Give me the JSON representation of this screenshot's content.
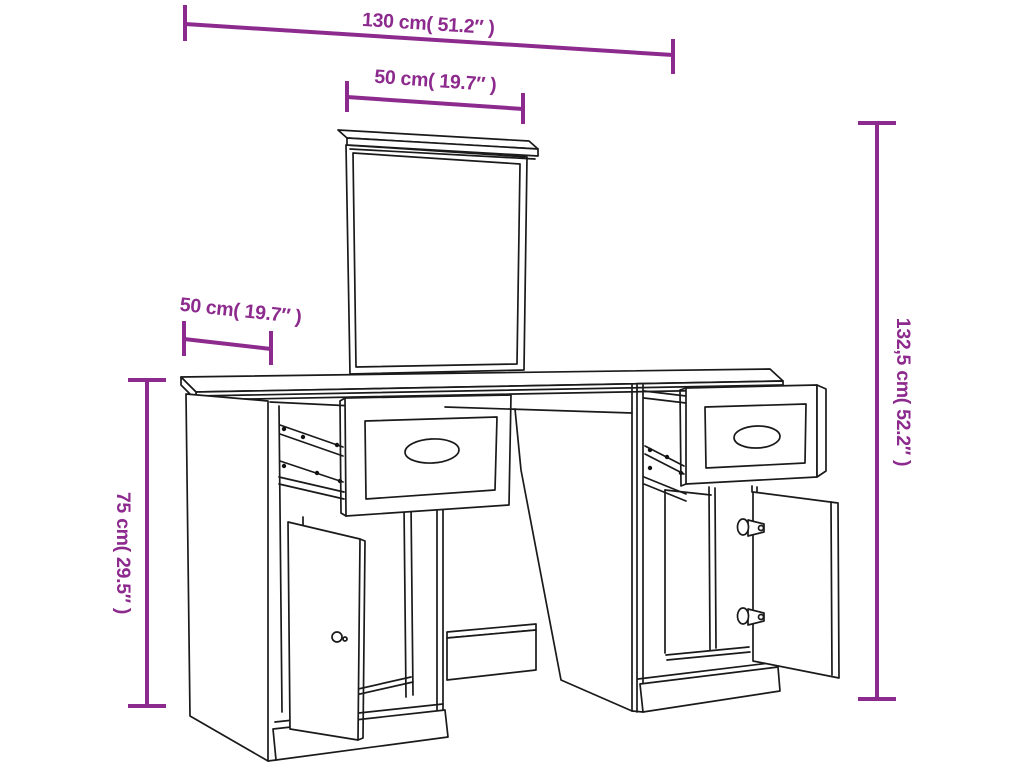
{
  "dimensions": {
    "overall_width": "130 cm( 51.2″ )",
    "mirror_width": "50 cm( 19.7″ )",
    "depth": "50 cm( 19.7″ )",
    "desk_height": "75 cm( 29.5″ )",
    "total_height": "132,5 cm( 52.2″ )"
  },
  "colors": {
    "dimension_annotation": "#8D2A8D",
    "line_art": "#1A1A1A",
    "background": "#FFFFFF"
  }
}
